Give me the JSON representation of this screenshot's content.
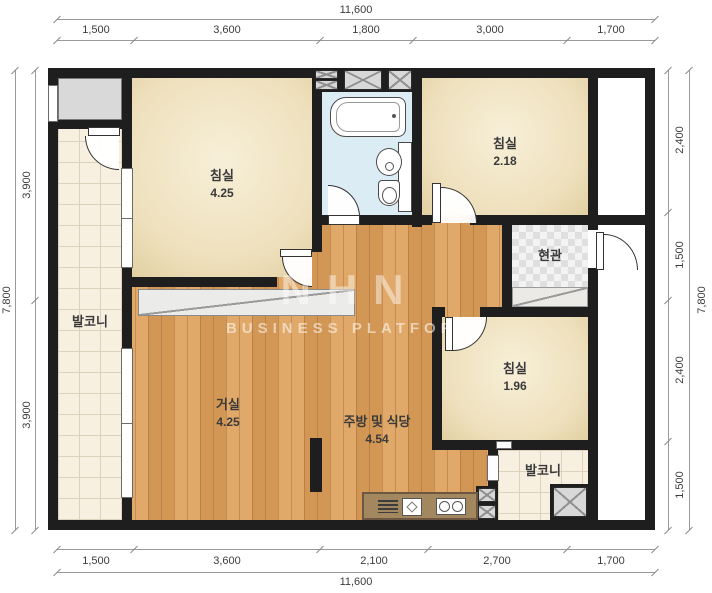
{
  "dims": {
    "top": {
      "total": "11,600",
      "segments": [
        "1,500",
        "3,600",
        "1,800",
        "3,000",
        "1,700"
      ]
    },
    "bottom": {
      "total": "11,600",
      "segments": [
        "1,500",
        "3,600",
        "2,100",
        "2,700",
        "1,700"
      ]
    },
    "left": {
      "total": "7,800",
      "segments": [
        "3,900",
        "3,900"
      ]
    },
    "right": {
      "total": "7,800",
      "segments": [
        "2,400",
        "1,500",
        "2,400",
        "1,500"
      ]
    }
  },
  "rooms": {
    "bedroom1": {
      "name": "침실",
      "area": "4.25"
    },
    "bedroom2": {
      "name": "침실",
      "area": "2.18"
    },
    "bedroom3": {
      "name": "침실",
      "area": "1.96"
    },
    "living": {
      "name": "거실",
      "area": "4.25"
    },
    "kitchen": {
      "name": "주방 및 식당",
      "area": "4.54"
    },
    "entrance": {
      "name": "현관"
    },
    "balcony_left": {
      "name": "발코니"
    },
    "balcony_right": {
      "name": "발코니"
    }
  },
  "watermark": {
    "logo": "NHN",
    "text": "BUSINESS PLATFORM"
  },
  "colors": {
    "wall": "#1e1e1e",
    "wood_floor": "#dd9f58",
    "room_cream": "#f1e7cc",
    "bathroom_blue": "#dcecf5",
    "balcony_tile": "#f7f0e1",
    "counter_brown": "#a3875f"
  }
}
